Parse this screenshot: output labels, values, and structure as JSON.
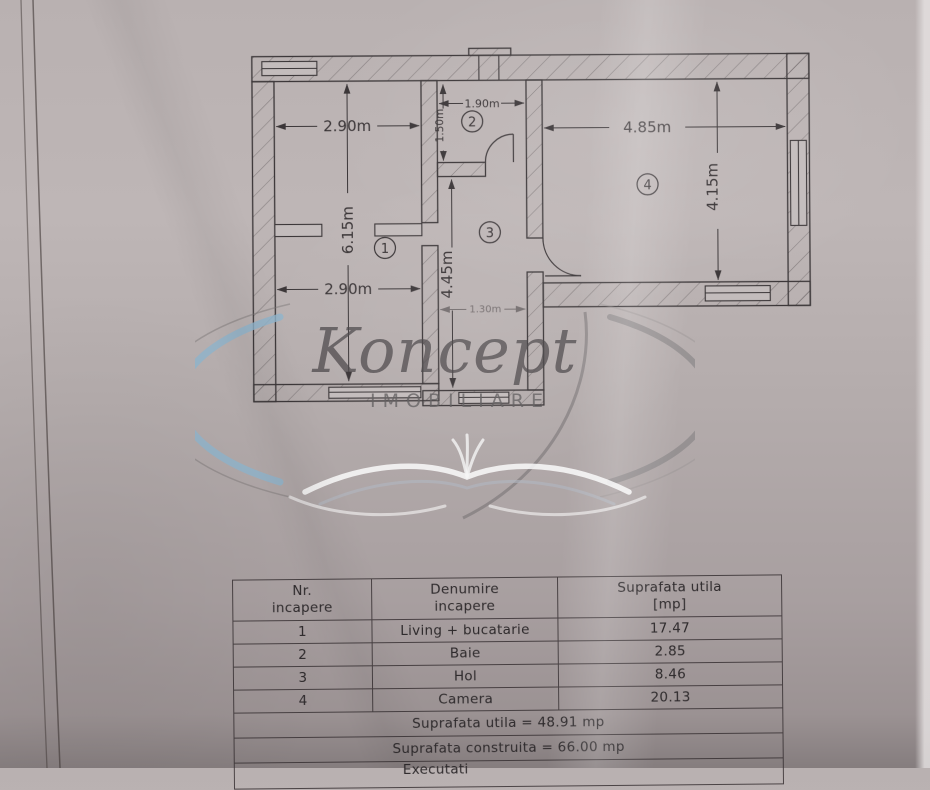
{
  "colors": {
    "ink": "#3b3638",
    "paper": "#b6aeae",
    "watermark_blue": "#8eb4cc",
    "watermark_gray": "#8a8a8c"
  },
  "plan": {
    "dims": {
      "room1_width_top": "2.90m",
      "room1_height": "6.15m",
      "room1_width_bottom": "2.90m",
      "room2_width": "1.90m",
      "room2_height": "1.50m",
      "hall_height": "4.45m",
      "hall_width_bottom": "1.30m",
      "room4_width": "4.85m",
      "room4_height": "4.15m"
    },
    "room_numbers": {
      "r1": "1",
      "r2": "2",
      "r3": "3",
      "r4": "4"
    }
  },
  "watermark": {
    "brand": "Koncept",
    "subtitle": "IMOBILIARE"
  },
  "table": {
    "header": {
      "col1_line1": "Nr.",
      "col1_line2": "incapere",
      "col2_line1": "Denumire",
      "col2_line2": "incapere",
      "col3_line1": "Suprafata utila",
      "col3_line2": "[mp]"
    },
    "rows": [
      {
        "nr": "1",
        "name": "Living + bucatarie",
        "area": "17.47"
      },
      {
        "nr": "2",
        "name": "Baie",
        "area": "2.85"
      },
      {
        "nr": "3",
        "name": "Hol",
        "area": "8.46"
      },
      {
        "nr": "4",
        "name": "Camera",
        "area": "20.13"
      }
    ],
    "footer1": "Suprafata utila = 48.91 mp",
    "footer2": "Suprafata construita = 66.00 mp",
    "footer3": "Executati"
  }
}
